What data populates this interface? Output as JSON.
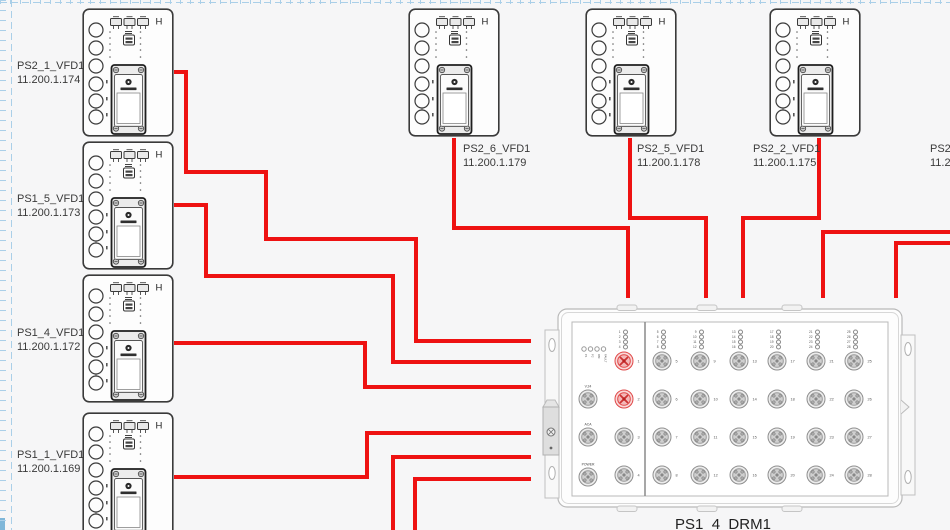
{
  "diagram": {
    "left_devices": [
      {
        "name": "PS2_1_VFD1",
        "ip": "11.200.1.174"
      },
      {
        "name": "PS1_5_VFD1",
        "ip": "11.200.1.173"
      },
      {
        "name": "PS1_4_VFD1",
        "ip": "11.200.1.172"
      },
      {
        "name": "PS1_1_VFD1",
        "ip": "11.200.1.169"
      }
    ],
    "top_devices": [
      {
        "name": "PS2_6_VFD1",
        "ip": "11.200.1.179"
      },
      {
        "name": "PS2_5_VFD1",
        "ip": "11.200.1.178"
      },
      {
        "name": "PS2_2_VFD1",
        "ip": "11.200.1.175"
      },
      {
        "name": "PS2_",
        "ip": "11.2"
      }
    ],
    "drm": {
      "name": "PS1_4_DRM1",
      "status_leds": [
        "P1",
        "P2",
        "RM",
        "FAULT"
      ],
      "side_ports": [
        "V.24",
        "ACA",
        "POWER"
      ],
      "port_count": 28,
      "highlighted_ports": [
        1,
        2
      ]
    },
    "colors": {
      "cable": "#ee1212",
      "highlight_port": "#e04848",
      "grid": "#aacfe8"
    },
    "cables": {
      "paths": [
        [
          [
            174,
            72
          ],
          [
            186,
            72
          ],
          [
            186,
            172
          ],
          [
            266,
            172
          ],
          [
            266,
            239
          ],
          [
            416,
            239
          ],
          [
            416,
            341
          ],
          [
            531,
            341
          ]
        ],
        [
          [
            174,
            205
          ],
          [
            206,
            205
          ],
          [
            206,
            276
          ],
          [
            393,
            276
          ],
          [
            393,
            362
          ],
          [
            531,
            362
          ]
        ],
        [
          [
            174,
            343
          ],
          [
            365,
            343
          ],
          [
            365,
            387
          ],
          [
            531,
            387
          ]
        ],
        [
          [
            174,
            477
          ],
          [
            367,
            477
          ],
          [
            367,
            433
          ],
          [
            531,
            433
          ]
        ],
        [
          [
            393,
            532
          ],
          [
            393,
            457
          ],
          [
            531,
            457
          ]
        ],
        [
          [
            415,
            532
          ],
          [
            415,
            479
          ],
          [
            531,
            479
          ]
        ],
        [
          [
            454,
            138
          ],
          [
            454,
            228
          ],
          [
            628,
            228
          ],
          [
            628,
            298
          ]
        ],
        [
          [
            630,
            138
          ],
          [
            630,
            218
          ],
          [
            706,
            218
          ],
          [
            706,
            298
          ]
        ],
        [
          [
            819,
            138
          ],
          [
            819,
            218
          ],
          [
            743,
            218
          ],
          [
            743,
            298
          ]
        ],
        [
          [
            952,
            232
          ],
          [
            823,
            232
          ],
          [
            823,
            298
          ]
        ],
        [
          [
            952,
            243
          ],
          [
            896,
            243
          ],
          [
            896,
            298
          ]
        ]
      ]
    }
  }
}
